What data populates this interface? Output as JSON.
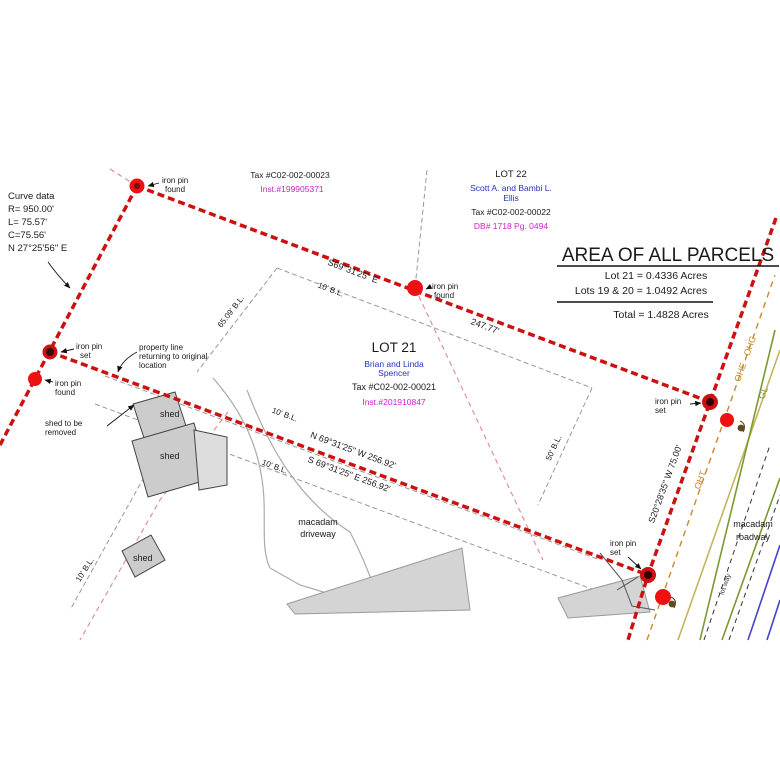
{
  "area_table": {
    "title": "AREA OF ALL PARCELS",
    "row_lot21": "Lot 21 =  0.4336 Acres",
    "row_lots19_20": "Lots 19 & 20 =  1.0492 Acres",
    "row_total": "Total =  1.4828 Acres"
  },
  "curve": {
    "l1": "Curve data",
    "l2": "R= 950.00'",
    "l3": "L= 75.57'",
    "l4": "C=75.56'",
    "l5": "N 27°25'56\" E"
  },
  "adjoiner": {
    "tax": "Tax #C02-002-00023",
    "inst": "Inst.#199905371"
  },
  "lot22": {
    "name": "LOT 22",
    "owner1": "Scott A. and Bambi L.",
    "owner2": "Ellis",
    "tax": "Tax #C02-002-00022",
    "deed": "DB# 1718 Pg. 0494"
  },
  "lot21": {
    "name": "LOT 21",
    "owner1": "Brian and Linda",
    "owner2": "Spencer",
    "tax": "Tax #C02-002-00021",
    "inst": "Inst.#201910847"
  },
  "bearings": {
    "north_line": "S69°31'25\" E",
    "north_dist": "247.77'",
    "relocated": "N 69°31'25\" W  256.92'",
    "original": "S 69°31'25\" E  256.92'",
    "east_line": "S20°28'35\" W  75.00'"
  },
  "setbacks": {
    "bl10": "10' B.L.",
    "bl65": "65.09' B.L.",
    "bl50": "50' B.L."
  },
  "pins": {
    "pin_line1": "iron pin",
    "found": "found",
    "set": "set"
  },
  "notes": {
    "prop1": "property line",
    "prop2": "returning to original",
    "prop3": "location",
    "shed_rm1": "shed to be",
    "shed_rm2": "removed",
    "shed": "shed",
    "drive1": "macadam",
    "drive2": "driveway",
    "road1": "macadam",
    "road2": "roadway",
    "lotway": "lot way"
  },
  "utilities": {
    "oht": "OHT",
    "ohe": "OHE - OHC",
    "gl": "GL"
  },
  "colors": {
    "property_line": "#cc1111",
    "pin_red": "#ee1111",
    "owner_text": "#2233bb",
    "instrument_text": "#cc22cc",
    "utility_orange": "#c8882a",
    "gas_green": "#7a9a2e",
    "water_blue": "#4444cc"
  }
}
